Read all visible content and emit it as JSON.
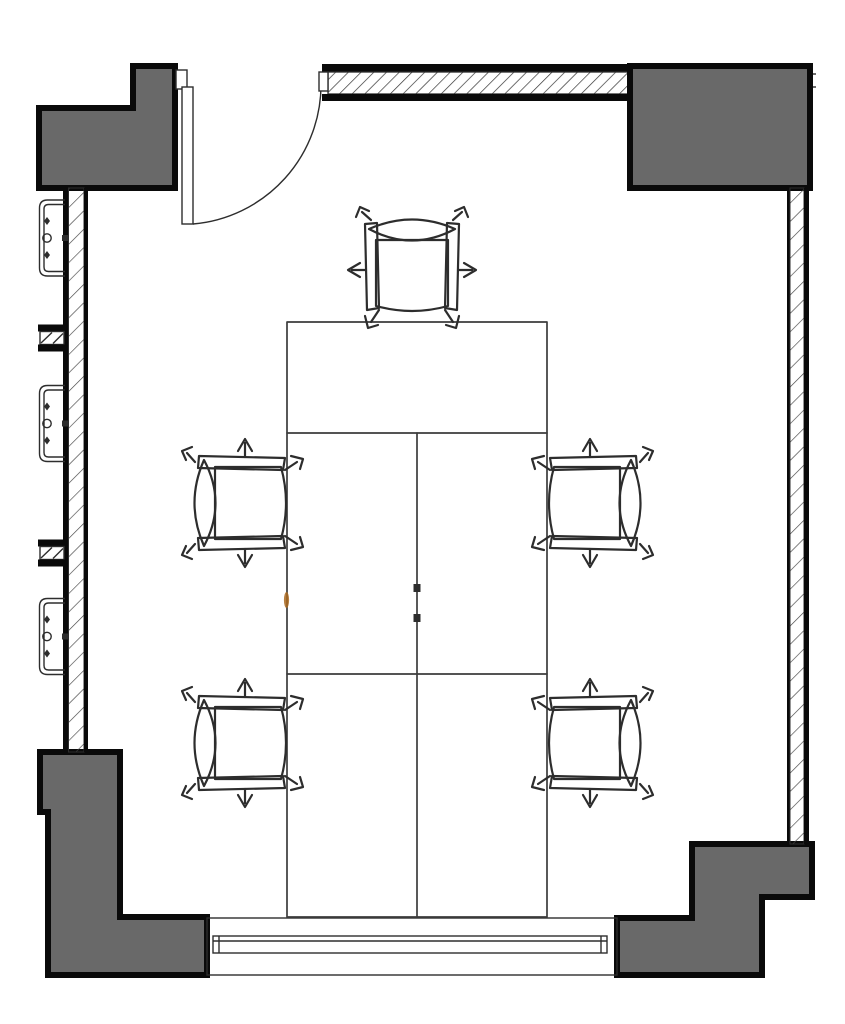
{
  "app": {
    "title": "Floor plan detail — meeting room"
  },
  "colors": {
    "background": "#ffffff",
    "column_fill": "#696969",
    "wall_line": "#0a0a0a",
    "thin_line": "#2d2d2d",
    "furniture_line": "#3c3c3c",
    "accent_mark": "#a8671f"
  },
  "plan": {
    "room_label": "Meeting room",
    "columns": [
      {
        "id": "top-left",
        "label": "Concrete column, top left (notched)"
      },
      {
        "id": "top-right",
        "label": "Concrete column, top right"
      },
      {
        "id": "bottom-left",
        "label": "Concrete column, bottom left (stepped)"
      },
      {
        "id": "bottom-right",
        "label": "Concrete column, bottom right (stepped)"
      }
    ],
    "walls": [
      {
        "id": "top",
        "label": "Top wall, hatched partition with door opening"
      },
      {
        "id": "left",
        "label": "Left wall, hatched, with convector units and piers"
      },
      {
        "id": "right",
        "label": "Right wall, hatched"
      }
    ],
    "door": {
      "label": "Single-leaf door with 90-degree swing arc",
      "position": "top left"
    },
    "window": {
      "label": "Window band with glazing lines",
      "position": "bottom"
    },
    "table": {
      "label": "Conference table, 3 segments",
      "segments": 3,
      "grommets": 2
    },
    "chairs": {
      "count": 5,
      "label": "Office chair",
      "positions": [
        "top",
        "left upper",
        "left lower",
        "right upper",
        "right lower"
      ]
    },
    "radiators": {
      "count": 3,
      "label": "Convector unit with fixing symbols"
    },
    "piers": {
      "count": 2,
      "label": "Hatched wall pier between openings"
    }
  }
}
